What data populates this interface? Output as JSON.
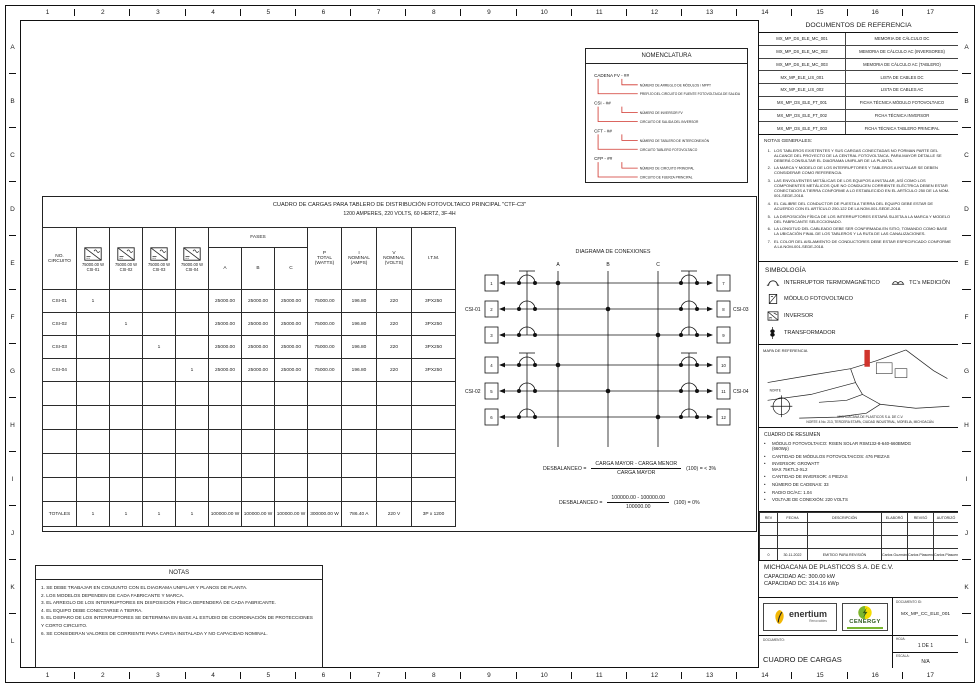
{
  "border": {
    "cols": [
      "1",
      "2",
      "3",
      "4",
      "5",
      "6",
      "7",
      "8",
      "9",
      "10",
      "11",
      "12",
      "13",
      "14",
      "15",
      "16",
      "17"
    ],
    "rows": [
      "A",
      "B",
      "C",
      "D",
      "E",
      "F",
      "G",
      "H",
      "I",
      "J",
      "K",
      "L"
    ]
  },
  "nomenclatura": {
    "title": "NOMENCLATURA",
    "groups": [
      {
        "code": "CADENA FV - ##",
        "items": [
          "NÚMERO DE ARREGLO DE MÓDULOS / MPPT",
          "PREFIJO DEL CIRCUITO DE FUENTE FOTOVOLTAICA DE SALIDA"
        ]
      },
      {
        "code": "CSI - ##",
        "items": [
          "NÚMERO DE INVERSOR FV",
          "CIRCUITO DE SALIDA DEL INVERSOR"
        ]
      },
      {
        "code": "CFT - ##",
        "items": [
          "NÚMERO DE TABLERO DE INTERCONEXIÓN",
          "CIRCUITO TABLERO FOTOVOLTAICO"
        ]
      },
      {
        "code": "CFP - ##",
        "items": [
          "NÚMERO DE CIRCUITO PRINCIPAL",
          "CIRCUITO DE FUERZA PRINCIPAL"
        ]
      }
    ],
    "accent_color": "#d0342c"
  },
  "load_table": {
    "title1": "CUADRO DE CARGAS PARA TABLERO DE DISTRIBUCIÓN FOTOVOLTAICO PRINCIPAL \"CTF-C3\"",
    "title2": "1200 AMPERES, 220 VOLTS, 60 HERTZ, 3F-4H",
    "headers": {
      "circuit": "NO.\nCIRCUITO",
      "fases": "FASES",
      "p_total": "P\nTOTAL\n(WATTS)",
      "i_nominal": "I\nNOMINAL\n(AMPS)",
      "v_nominal": "V\nNOMINAL\n(VOLTS)",
      "itm": "I.T.M."
    },
    "inverters": [
      {
        "power": "75000.00 W",
        "id": "CSI-01"
      },
      {
        "power": "75000.00 W",
        "id": "CSI-02"
      },
      {
        "power": "75000.00 W",
        "id": "CSI-03"
      },
      {
        "power": "75000.00 W",
        "id": "CSI-04"
      }
    ],
    "phases": [
      "A",
      "B",
      "C"
    ],
    "rows": [
      {
        "id": "CSI-01",
        "inv": [
          "1",
          "",
          "",
          ""
        ],
        "a": "25000.00",
        "b": "25000.00",
        "c": "25000.00",
        "p": "75000.00",
        "i": "196.80",
        "v": "220",
        "itm": "3PX250"
      },
      {
        "id": "CSI-02",
        "inv": [
          "",
          "1",
          "",
          ""
        ],
        "a": "25000.00",
        "b": "25000.00",
        "c": "25000.00",
        "p": "75000.00",
        "i": "196.80",
        "v": "220",
        "itm": "3PX250"
      },
      {
        "id": "CSI-03",
        "inv": [
          "",
          "",
          "1",
          ""
        ],
        "a": "25000.00",
        "b": "25000.00",
        "c": "25000.00",
        "p": "75000.00",
        "i": "196.80",
        "v": "220",
        "itm": "3PX250"
      },
      {
        "id": "CSI-04",
        "inv": [
          "",
          "",
          "",
          "1"
        ],
        "a": "25000.00",
        "b": "25000.00",
        "c": "25000.00",
        "p": "75000.00",
        "i": "196.80",
        "v": "220",
        "itm": "3PX250"
      }
    ],
    "empty_rows": 5,
    "totals": {
      "label": "TOTALES",
      "inv": [
        "1",
        "1",
        "1",
        "1"
      ],
      "a": "100000.00 W",
      "b": "100000.00 W",
      "c": "100000.00 W",
      "p": "300000.00 W",
      "i": "786.40 A",
      "v": "220 V",
      "itm": "3P x 1200"
    }
  },
  "diagram": {
    "title": "DIAGRAMA DE CONEXIONES",
    "phases": [
      "A",
      "B",
      "C"
    ],
    "left": [
      {
        "label": "CSI-01",
        "circuits": [
          "1",
          "2",
          "3"
        ]
      },
      {
        "label": "CSI-02",
        "circuits": [
          "4",
          "5",
          "6"
        ]
      }
    ],
    "right": [
      {
        "label": "CSI-03",
        "circuits": [
          "7",
          "8",
          "9"
        ]
      },
      {
        "label": "CSI-04",
        "circuits": [
          "10",
          "11",
          "12"
        ]
      }
    ]
  },
  "desbalanceo": {
    "f1": {
      "label": "DESBALANCEO =",
      "num": "CARGA MAYOR - CARGA MENOR",
      "den": "CARGA MAYOR",
      "suffix": "(100) = < 3%"
    },
    "f2": {
      "label": "DESBALANCEO =",
      "num": "100000.00 - 100000.00",
      "den": "100000.00",
      "suffix": "(100) = 0%"
    }
  },
  "notas": {
    "title": "NOTAS",
    "items": [
      "SE DEBE TRABAJAR EN CONJUNTO CON EL DIAGRAMA UNIFILAR Y PLANOS DE PLANTA.",
      "LOS MODELOS DEPENDEN DE CADA FABRICANTE Y MARCA.",
      "EL ARREGLO DE LOS INTERRUPTORES EN DISPOSICIÓN FÍSICA DEPENDERÁ DE CADA FABRICANTE.",
      "EL EQUIPO DEBE CONECTARSE A TIERRA.",
      "EL DISPARO DE LOS INTERRUPTORES SE DETERMINA EN BASE AL ESTUDIO DE COORDINACIÓN DE PROTECCIONES Y CORTO CIRCUITO.",
      "SE CONSIDERAN VALORES DE CORRIENTE PARA CARGA INSTALADA Y NO CAPACIDAD NOMINAL."
    ]
  },
  "ref_docs": {
    "title": "DOCUMENTOS DE REFERENCIA",
    "rows": [
      {
        "code": "MX_MP_DS_ELE_MC_001",
        "desc": "MEMORIA DE CÁLCULO DC"
      },
      {
        "code": "MX_MP_DS_ELE_MC_002",
        "desc": "MEMORIA DE CÁLCULO AC (INVERSORES)"
      },
      {
        "code": "MX_MP_DS_ELE_MC_003",
        "desc": "MEMORIA DE CÁLCULO AC (TABLERO)"
      },
      {
        "code": "MX_MP_ELE_LIS_001",
        "desc": "LISTA DE CABLES DC"
      },
      {
        "code": "MX_MP_ELE_LIS_002",
        "desc": "LISTA DE CABLES AC"
      },
      {
        "code": "MX_MP_DS_ELE_FT_001",
        "desc": "FICHA TÉCNICA MÓDULO FOTOVOLTAICO"
      },
      {
        "code": "MX_MP_DS_ELE_FT_002",
        "desc": "FICHA TÉCNICA INVERSOR"
      },
      {
        "code": "MX_MP_DS_ELE_FT_003",
        "desc": "FICHA TÉCNICA TABLERO PRINCIPAL"
      }
    ]
  },
  "general_notes": {
    "title": "NOTAS GENERALES:",
    "items": [
      "LOS TABLEROS EXISTENTES Y SUS CARGAS CONECTADAS NO FORMAN PARTE DEL ALCANCE DEL PROYECTO DE LA CENTRAL FOTOVOLTAICA. PARA MAYOR DETALLE SE DEBERÁ CONSULTAR EL DIAGRAMA UNIFILAR DE LA PLANTA.",
      "LA MARCA Y MODELO DE LOS INTERRUPTORES Y TABLEROS A INSTALAR SE DEBEN CONSIDERAR COMO REFERENCIA.",
      "LAS ENVOLVENTES METÁLICAS DE LOS EQUIPOS A INSTALAR, ASÍ COMO LOS COMPONENTES METÁLICOS QUE NO CONDUCEN CORRIENTE ELÉCTRICA DEBEN ESTAR CONECTADOS A TIERRA CONFORME A LO ESTABLECIDO EN EL ARTÍCULO 250 DE LA NOM-001-SEDE-2018.",
      "EL CALIBRE DEL CONDUCTOR DE PUESTA A TIERRA DEL EQUIPO DEBE ESTAR DE ACUERDO CON EL ARTÍCULO 250-122 DE LA NOM-001-SEDE-2018.",
      "LA DISPOSICIÓN FÍSICA DE LOS INTERRUPTORES ESTARÁ SUJETA A LA MARCA Y MODELO DEL FABRICANTE SELECCIONADO.",
      "LA LONGITUD DEL CABLEADO DEBE SER CONFIRMADA EN SITIO, TOMANDO COMO BASE LA UBICACIÓN FINAL DE LOS TABLEROS Y LA RUTA DE LAS CANALIZACIONES.",
      "EL COLOR DEL AISLAMIENTO DE CONDUCTORES DEBE ESTAR ESPECIFICADO CONFORME A LA NOM-001-SEDE-2018."
    ]
  },
  "simbologia": {
    "title": "SIMBOLOGÍA",
    "items": [
      {
        "icon": "breaker-icon",
        "label": "INTERRUPTOR TERMOMAGNÉTICO"
      },
      {
        "icon": "ct-icon",
        "label": "TC's MEDICIÓN"
      },
      {
        "icon": "pv-module-icon",
        "label": "MÓDULO FOTOVOLTAICO"
      },
      {
        "icon": "inverter-icon",
        "label": "INVERSOR"
      },
      {
        "icon": "transformer-icon",
        "label": "TRANSFORMADOR"
      },
      {
        "icon": "meter-icon",
        "label": "MEDIDOR CFE"
      }
    ]
  },
  "mapa": {
    "title": "MAPA DE REFERENCIA",
    "north_label": "NORTE",
    "caption1": "MICHOACANA DE PLASTICOS S.A. DE C.V.",
    "caption2": "NORTE 4 No. 213, TERCERA ETAPA, CIUDAD INDUSTRIAL, MORELIA, MICHOACÁN.",
    "marker_color": "#d0342c"
  },
  "resumen": {
    "title": "CUADRO DE RESUMEN",
    "items": [
      "MÓDULO FOTOVOLTAICO: RISEN SOLAR RSM132-8-640-660BMDG\n(660Wp)",
      "CANTIDAD DE MÓDULOS FOTOVOLTAICOS: 476 PIEZAS",
      "INVERSOR: GROWATT\nMAX 75KTL3-XL2",
      "CANTIDAD DE INVERSOR: 4 PIEZAS",
      "NÚMERO DE CADENAS: 33",
      "RADIO DC/AC: 1.04",
      "VOLTAJE DE CONEXIÓN: 220 VOLTS"
    ]
  },
  "revisions": {
    "headers": [
      "REV",
      "FECHA",
      "DESCRIPCIÓN",
      "ELABORÓ",
      "REVISÓ",
      "AUTORIZÓ"
    ],
    "rows": [
      [
        "",
        "",
        "",
        "",
        "",
        ""
      ],
      [
        "",
        "",
        "",
        "",
        "",
        ""
      ],
      [
        "0",
        "30-11-2022",
        "EMITIDO PARA REVISIÓN",
        "Carlos Guzmán",
        "Carlos Plascencia",
        "Carlos Plascencia"
      ]
    ]
  },
  "project": {
    "name": "MICHOACANA DE PLASTICOS S.A. DE C.V.",
    "cap_ac": "CAPACIDAD AC: 300.00 kW",
    "cap_dc": "CAPACIDAD DC: 314.16 kWp"
  },
  "logos": {
    "enertium": {
      "name": "enertium",
      "tagline": "Renovables",
      "color": "#f2b705"
    },
    "cenergy": {
      "name": "CENERGY",
      "green": "#79b530",
      "yellow": "#f5dc00"
    }
  },
  "titleblock": {
    "doc_id_label": "DOCUMENTO ID:",
    "doc_id": "MX_MP_CC_ELE_001",
    "doc_label": "DOCUMENTO:",
    "doc_name": "CUADRO DE CARGAS",
    "sheet_label": "HOJA:",
    "sheet": "1 DE 1",
    "scale_label": "ESCALA:",
    "scale": "N/A"
  }
}
